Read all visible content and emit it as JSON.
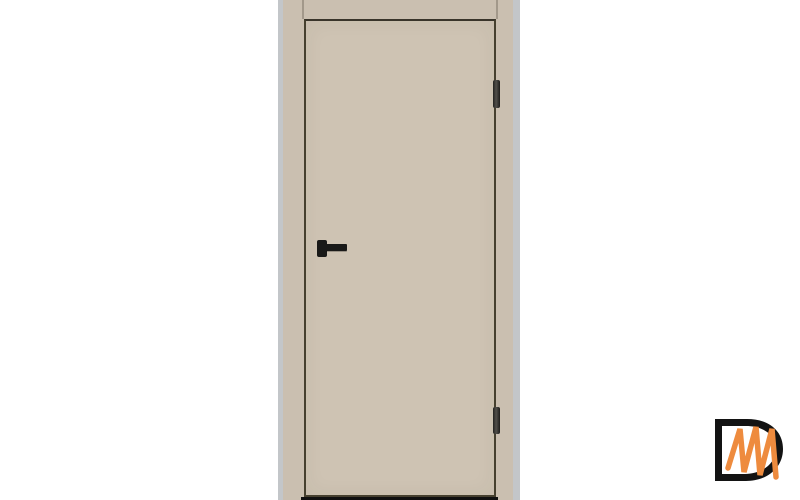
{
  "product_image": {
    "alt": "Beige flush interior door, closed in matching beige frame, black lever handle, two black hinges on right side",
    "door": {
      "style": "flush-flat-panel",
      "state": "closed",
      "hinge_count": 2,
      "handle_side": "left",
      "hinge_side": "right"
    }
  },
  "watermark": {
    "text": "Dm",
    "letters": [
      "D",
      "m"
    ]
  },
  "colors": {
    "background": "#ffffff",
    "wall-strip": "#c3c6c9",
    "frame": "#cabfb0",
    "joint-line": "#a2988a",
    "leaf": "#cec3b3",
    "leaf-edge": "#46402f",
    "hardware": "#191918",
    "hinge-light": "#52504b",
    "floor-shadow": "#101010",
    "logo-black": "#131313",
    "logo-orange": "#ee8b3e"
  }
}
